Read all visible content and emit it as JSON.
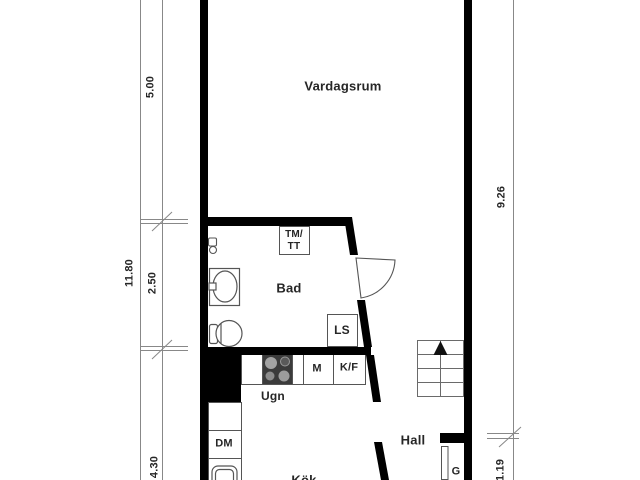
{
  "rooms": {
    "living": "Vardagsrum",
    "bath": "Bad",
    "kitchen": "Kök",
    "hall": "Hall"
  },
  "appliances": {
    "washer_dryer_line1": "TM/",
    "washer_dryer_line2": "TT",
    "ls_closet": "LS",
    "micro": "M",
    "fridge_freezer": "K/F",
    "oven": "Ugn",
    "dishwasher": "DM",
    "wardrobe": "G"
  },
  "dimensions": {
    "left_total": "11.80",
    "left_top": "5.00",
    "left_middle": "2.50",
    "left_bottom": "4.30",
    "right_upper": "9.26",
    "right_lower": "1.19"
  },
  "colors": {
    "wall": "#000000",
    "fixture_line": "#555555",
    "dimension_line": "#888888",
    "text": "#262626",
    "stove_body": "#3b3b3b"
  }
}
